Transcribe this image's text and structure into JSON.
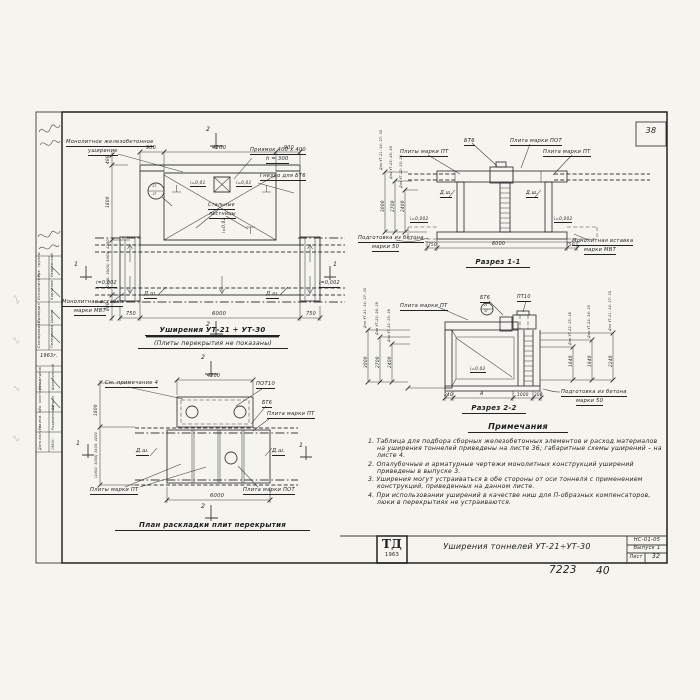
{
  "sheet": {
    "corner_number": "38",
    "title": "Уширения тоннелей УТ-21÷УТ-30",
    "code": "НС-01-05",
    "issue": "Выпуск 1",
    "sheet_word": "Лист",
    "sheet_number": "32",
    "logo": "ТД",
    "logo_year": "1963",
    "footer_left": "7223",
    "footer_right": "40"
  },
  "plan": {
    "title": "Уширения УТ-21 ÷ УТ-30",
    "subtitle": "(Плиты перекрытия не показаны)",
    "callout_monolithic_1": "Монолитное железобетонное",
    "callout_monolithic_2": "уширение",
    "callout_pit_1": "Приямок 400 х 400",
    "callout_pit_2": "h = 300",
    "callout_socket": "Гнездо для БТ6",
    "callout_insert_1": "Монолитная вставка",
    "callout_insert_2": "марки МВТ",
    "callout_ladders_1": "Стальные",
    "callout_ladders_2": "лестницы",
    "slope_left": "i=0,01",
    "slope_right": "i=0,01",
    "slope_mid": "i=0,02",
    "slope_edge_left": "i=0,002",
    "slope_edge_right": "i=0,002",
    "axis_label": "Д.ш.",
    "circle_top": "2Г",
    "circle_bottom": "3Г",
    "dim_top_1": "900",
    "dim_top_2": "4200",
    "dim_top_3": "900",
    "dim_bottom_1": "750",
    "dim_bottom_2": "6000",
    "dim_bottom_3": "750",
    "dim_left_1": "400",
    "dim_left_2": "1800",
    "dim_left_3": "(2400; 3000) 3400; 4200",
    "dim_left_4": "800",
    "mark_2": "2",
    "mark_1": "1"
  },
  "section1": {
    "title": "Разрез 1-1",
    "callout_bt6": "БТ6",
    "callout_pot": "Плита марки ПОТ",
    "callout_pt_left": "Плиты марки ПТ",
    "callout_pt_right": "Плита марки ПТ",
    "callout_insert_1": "Монолитная вставка",
    "callout_insert_2": "марки МВТ",
    "callout_prep_1": "Подготовка из бетона",
    "callout_prep_2": "марки 50",
    "axis_label": "Д.ш.",
    "slope_left": "i=0,002",
    "slope_right": "i=0,002",
    "dim_bottom_1": "750",
    "dim_bottom_2": "6000",
    "dim_bottom_3": "750",
    "dim_left": [
      {
        "value": "3000",
        "label": "Для УТ-21; 24; 27; 30"
      },
      {
        "value": "2700",
        "label": "Для УТ-23; 26; 29"
      },
      {
        "value": "2400",
        "label": "Для УТ-22; 25; 28"
      }
    ]
  },
  "section2": {
    "title": "Разрез 2-2",
    "callout_pt": "Плита марки ПТ",
    "callout_bt6": "БТ6",
    "callout_pt10": "ПТ10",
    "callout_prep_1": "Подготовка из бетона",
    "callout_prep_2": "марки 50",
    "circle_top": "2Г",
    "circle_bottom": "3Г",
    "slope": "i=0,02",
    "dim_bottom_1": "240",
    "dim_bottom_2": "А",
    "dim_bottom_3": "1000",
    "dim_bottom_4": "300",
    "dim_left": [
      {
        "value": "3000",
        "label": "Для УТ-21; 24; 27; 30"
      },
      {
        "value": "2700",
        "label": "Для УТ-23; 26; 29"
      },
      {
        "value": "2400",
        "label": "Для УТ-22; 25; 28"
      }
    ],
    "dim_right": [
      {
        "value": "1640",
        "label": "Для УТ-22; 25; 28"
      },
      {
        "value": "1940",
        "label": "Для УТ-23; 26; 29"
      },
      {
        "value": "2240",
        "label": "Для УТ-21; 24; 27; 30"
      }
    ]
  },
  "slab_plan": {
    "title": "План раскладки плит перекрытия",
    "callout_note": "См. примечание 4",
    "callout_pot10": "ПОТ10",
    "callout_bt6": "БТ6",
    "callout_pt": "Плита марки ПТ",
    "callout_pts": "Плиты марки ПТ",
    "callout_pot": "Плита марки ПОТ",
    "axis_label": "Д.ш.",
    "dim_top": "4200",
    "dim_left": "1800",
    "dim_left_rot": "(2400; 3000) 3400; 4200",
    "dim_bottom": "6000",
    "mark_2": "2",
    "mark_1": "1"
  },
  "notes": {
    "title": "Примечания",
    "items": [
      "1. Таблица для подбора сборных железобетонных элементов и расход материалов на уширения тоннелей приведены на листе 36; габаритные схемы уширений – на листе 4.",
      "2. Опалубочные и арматурные чертежи монолитных конструкций уширений приведены в выпуске 3.",
      "3. Уширения могут устраиваться в обе стороны от оси тоннеля с применением конструкций, приведенных на данном листе.",
      "4. При использовании уширений в качестве ниш для П-образных компенсаторов, люки в перекрытиях не устраиваются."
    ]
  },
  "stamp": {
    "year": "1963г.",
    "rows_top": [
      {
        "role": "Рук. группы",
        "name": "Уваровский"
      },
      {
        "role": "Исполнитель",
        "name": "Корнилов"
      },
      {
        "role": "Проверил",
        "name": "Цыпин"
      },
      {
        "role": "Скопировала",
        "name": "Полежаева"
      }
    ],
    "rows_bottom": [
      {
        "role": "Нач. отдела",
        "name": "Шаполянский"
      },
      {
        "role": "Гл. конструктор",
        "name": "Бандюк"
      },
      {
        "role": "Гл. инж. пр.",
        "name": "Родименский"
      },
      {
        "role": "Дата выпуска",
        "name": "1963г."
      }
    ]
  }
}
